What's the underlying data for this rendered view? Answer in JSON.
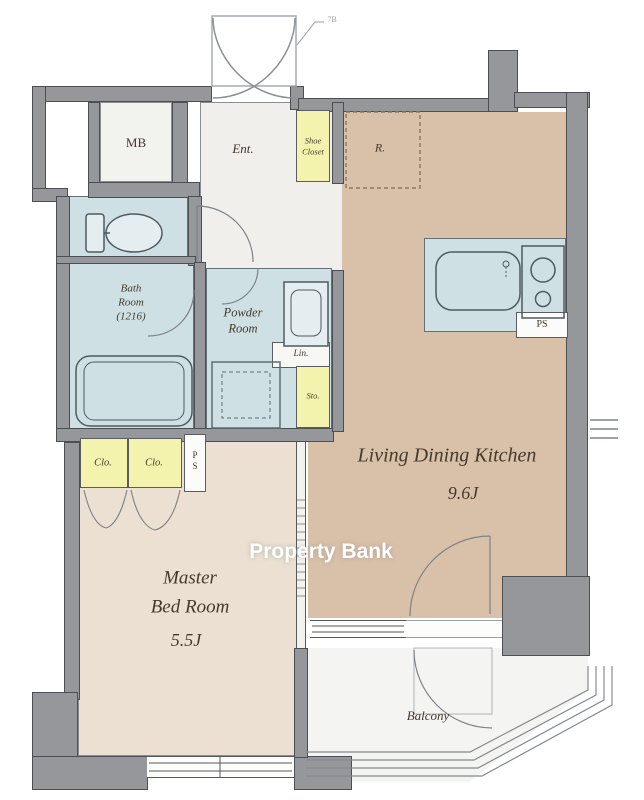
{
  "floorplan": {
    "door_label": "7B",
    "watermark": "Property Bank",
    "rooms": {
      "mb": {
        "label": "MB"
      },
      "entrance": {
        "label": "Ent."
      },
      "shoe_closet": {
        "line1": "Shoe",
        "line2": "Closet"
      },
      "refrigerator_space": {
        "label": "R."
      },
      "bath": {
        "line1": "Bath",
        "line2": "Room",
        "line3": "(1216)"
      },
      "powder": {
        "line1": "Powder",
        "line2": "Room"
      },
      "linen": {
        "label": "Lin."
      },
      "storage": {
        "label": "Sto."
      },
      "pipe_space_kitchen": {
        "label": "PS"
      },
      "pipe_space_closet": {
        "line1": "P",
        "line2": "S"
      },
      "ldk": {
        "label": "Living Dining Kitchen",
        "size": "9.6J"
      },
      "closet_left": {
        "label": "Clo."
      },
      "closet_right": {
        "label": "Clo."
      },
      "master_bedroom": {
        "line1": "Master",
        "line2": "Bed Room",
        "size": "5.5J"
      },
      "balcony": {
        "label": "Balcony"
      }
    },
    "colors": {
      "wall": "#96979b",
      "wall_edge": "#4b4e53",
      "ldk_floor": "#d9c0a8",
      "bedroom_floor": "#ebe0d2",
      "wet_area": "#cfe0e5",
      "closet_yellow": "#f4f3ae",
      "balcony_floor": "#f4f4f2",
      "hall_floor": "#f0efec",
      "label_text": "#453a2c",
      "watermark_text": "#ffffff"
    }
  }
}
